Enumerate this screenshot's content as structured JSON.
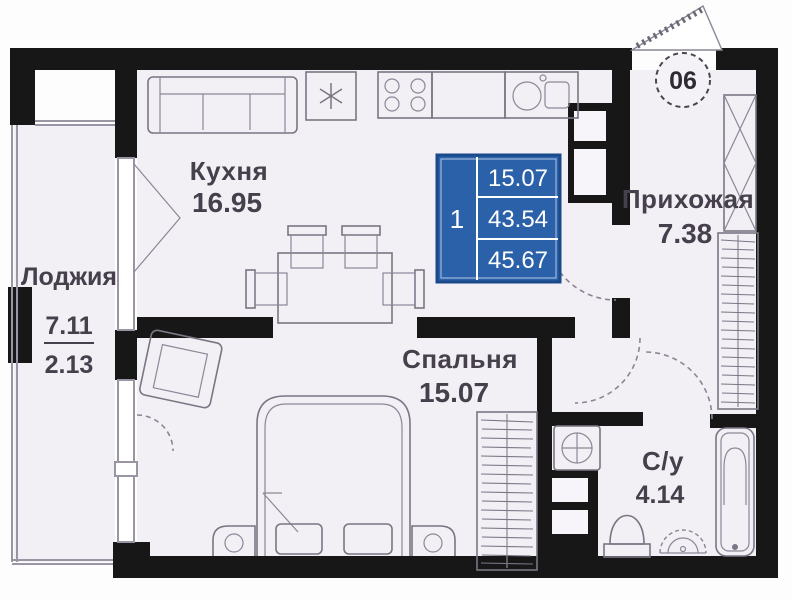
{
  "plan_title": "apartment-floor-plan",
  "entrance": {
    "apartment_number": "06"
  },
  "rooms": {
    "kitchen": {
      "label": "Кухня",
      "area": "16.95"
    },
    "loggia": {
      "label": "Лоджия",
      "area_full": "7.11",
      "area_coef": "2.13"
    },
    "hallway": {
      "label": "Прихожая",
      "area": "7.38"
    },
    "bedroom": {
      "label": "Спальня",
      "area": "15.07"
    },
    "bathroom": {
      "label": "С/у",
      "area": "4.14"
    }
  },
  "info_box": {
    "rooms_count": "1",
    "values": [
      "15.07",
      "43.54",
      "45.67"
    ],
    "color": "#2a61a9",
    "border_color": "#1a4a8b"
  },
  "icons": {
    "fridge": "snowflake-icon",
    "stove": "four-burners-icon",
    "washer": "drum-cross-icon"
  },
  "colors": {
    "walls": "#171717",
    "room_fill": "#f2eff5",
    "furniture_line": "#7b7584",
    "text": "#45404b"
  }
}
